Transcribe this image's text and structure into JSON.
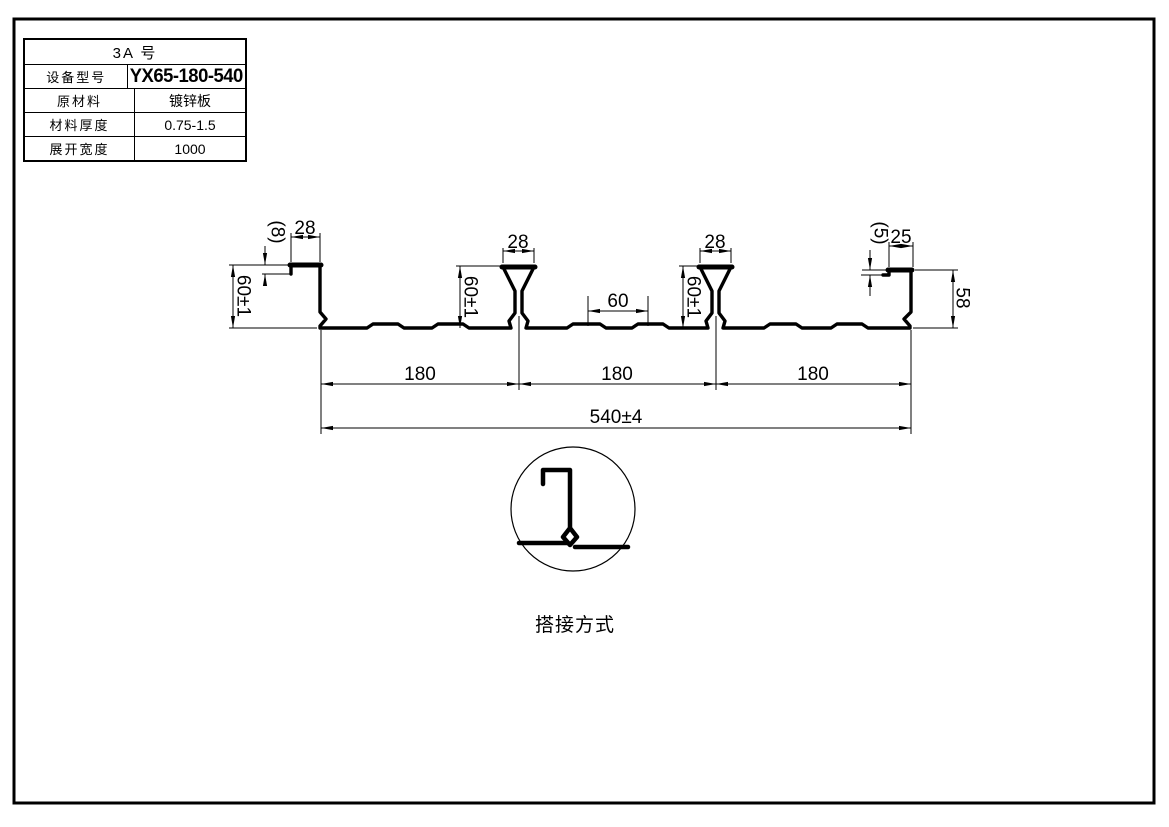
{
  "colors": {
    "background": "#ffffff",
    "line": "#000000"
  },
  "spec_table": {
    "title": "3A  号",
    "rows": [
      {
        "label": "设备型号",
        "value": "YX65-180-540"
      },
      {
        "label": "原材料",
        "value": "镀锌板"
      },
      {
        "label": "材料厚度",
        "value": "0.75-1.5"
      },
      {
        "label": "展开宽度",
        "value": "1000"
      }
    ]
  },
  "profile": {
    "dims": {
      "left_edge_height": "60±1",
      "left_lip": "(8)",
      "left_flange_width": "28",
      "rib1_top_width": "28",
      "rib1_height": "60±1",
      "mid_embossment_spacing": "60",
      "rib2_top_width": "28",
      "rib2_height": "60±1",
      "right_lip": "(5)",
      "right_flange_width": "25",
      "right_edge_height": "58",
      "span_1": "180",
      "span_2": "180",
      "span_3": "180",
      "overall_width": "540±4"
    }
  },
  "detail": {
    "caption": "搭接方式"
  }
}
